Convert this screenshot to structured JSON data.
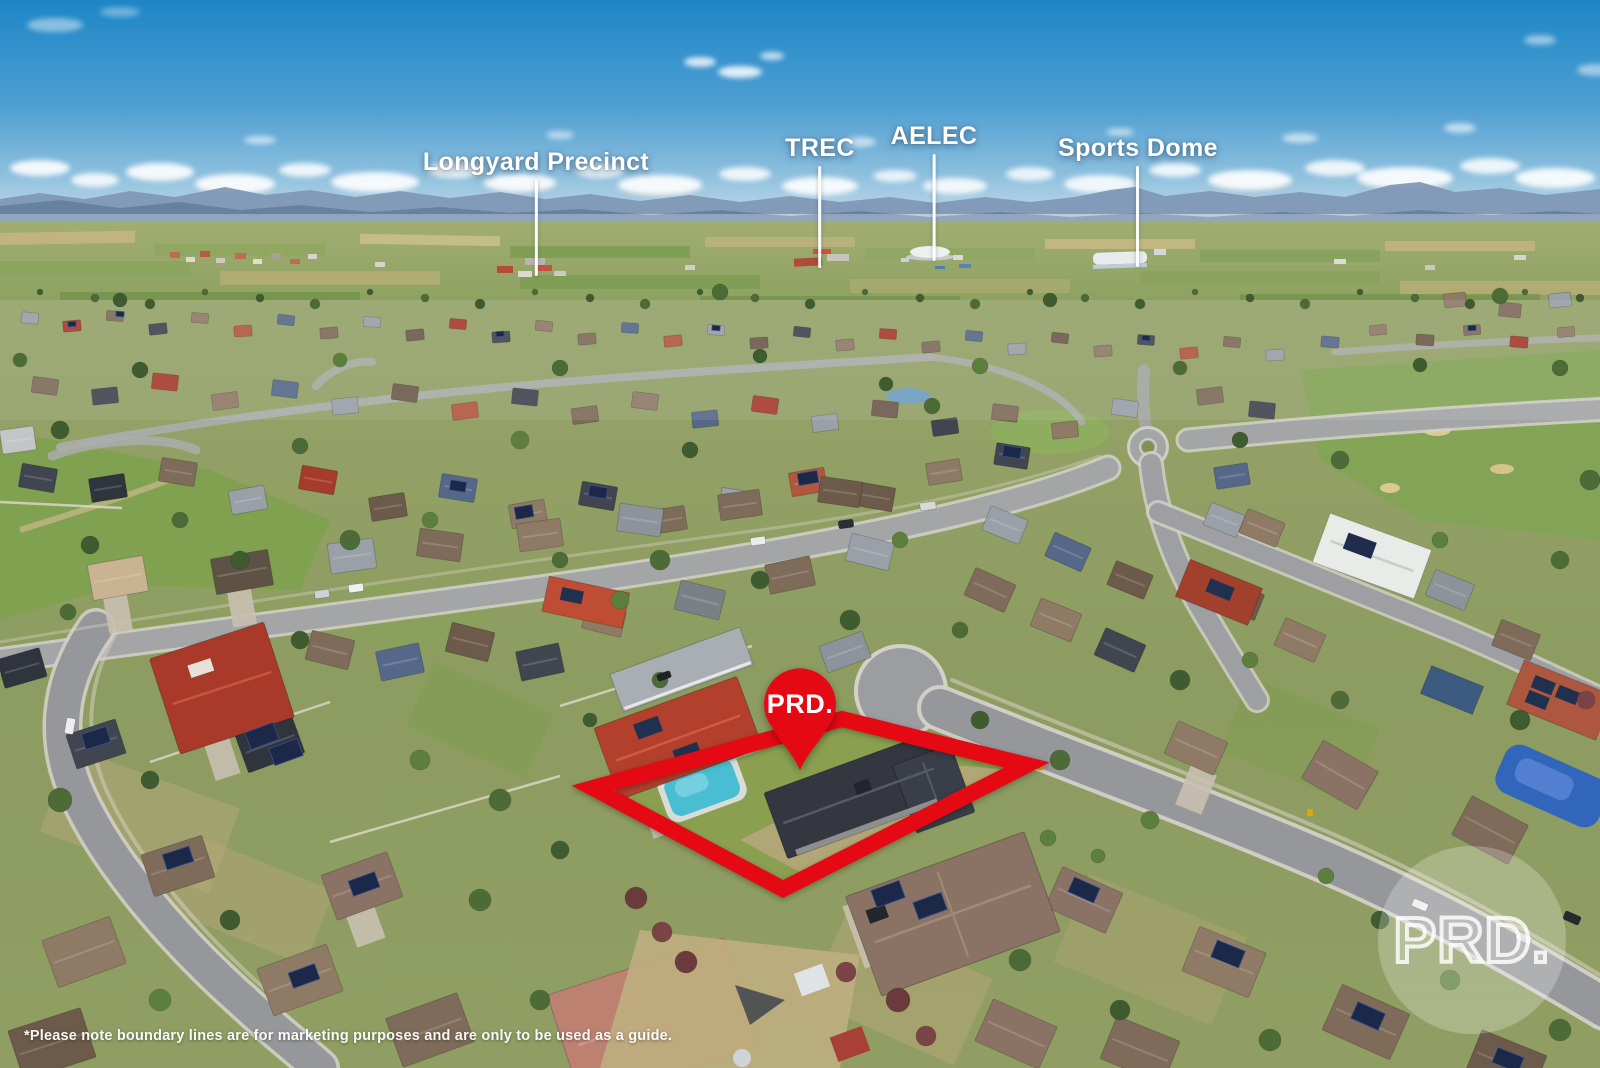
{
  "annotations": {
    "landmarks": [
      {
        "label": "Longyard Precinct"
      },
      {
        "label": "TREC"
      },
      {
        "label": "AELEC"
      },
      {
        "label": "Sports Dome"
      }
    ],
    "pin": {
      "label": "PRD."
    },
    "watermark": {
      "label": "PRD."
    },
    "disclaimer": "*Please note boundary lines are for marketing purposes and are only to be used as a guide.",
    "colors": {
      "brand_red": "#e50914",
      "label_white": "#ffffff"
    }
  }
}
